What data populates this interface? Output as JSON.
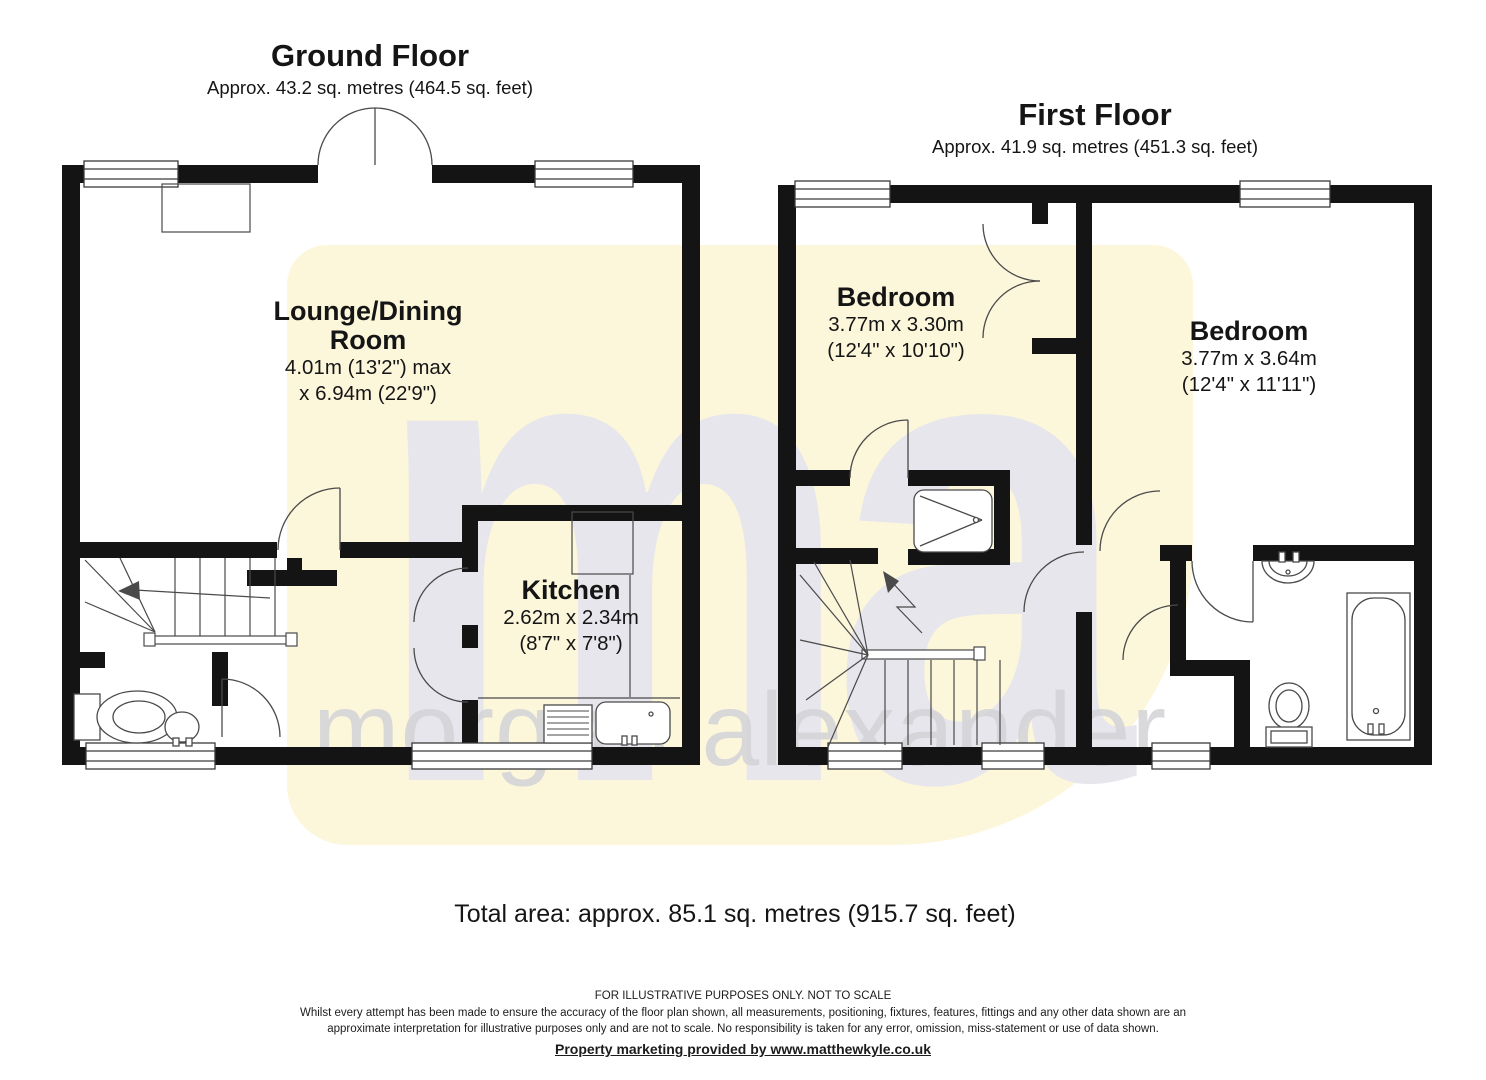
{
  "watermark": {
    "logo": "ma",
    "brand": "morgan alexander",
    "yellow_color": "#fcf6da",
    "letter_color": "#e6e6ec",
    "brand_color": "#d5d5d9"
  },
  "ground_floor": {
    "title": "Ground Floor",
    "area": "Approx. 43.2 sq. metres (464.5 sq. feet)",
    "lounge": {
      "name1": "Lounge/Dining",
      "name2": "Room",
      "dim1": "4.01m (13'2\") max",
      "dim2": "x 6.94m (22'9\")"
    },
    "kitchen": {
      "name": "Kitchen",
      "dim1": "2.62m x 2.34m",
      "dim2": "(8'7\" x 7'8\")"
    }
  },
  "first_floor": {
    "title": "First Floor",
    "area": "Approx. 41.9 sq. metres (451.3 sq. feet)",
    "bedroom1": {
      "name": "Bedroom",
      "dim1": "3.77m x 3.30m",
      "dim2": "(12'4\" x 10'10\")"
    },
    "bedroom2": {
      "name": "Bedroom",
      "dim1": "3.77m x 3.64m",
      "dim2": "(12'4\" x 11'11\")"
    }
  },
  "total_area": "Total area: approx. 85.1 sq. metres (915.7 sq. feet)",
  "footer": {
    "line1": "FOR ILLUSTRATIVE PURPOSES ONLY. NOT TO SCALE",
    "line2": "Whilst every attempt has been made to ensure the accuracy of the floor plan shown, all measurements, positioning, fixtures, features, fittings and any other data shown are an",
    "line3": "approximate interpretation for illustrative purposes only and are not to scale. No responsibility is taken for any error, omission, miss-statement or use of data shown.",
    "line4": "Property marketing provided by www.matthewkyle.co.uk"
  }
}
